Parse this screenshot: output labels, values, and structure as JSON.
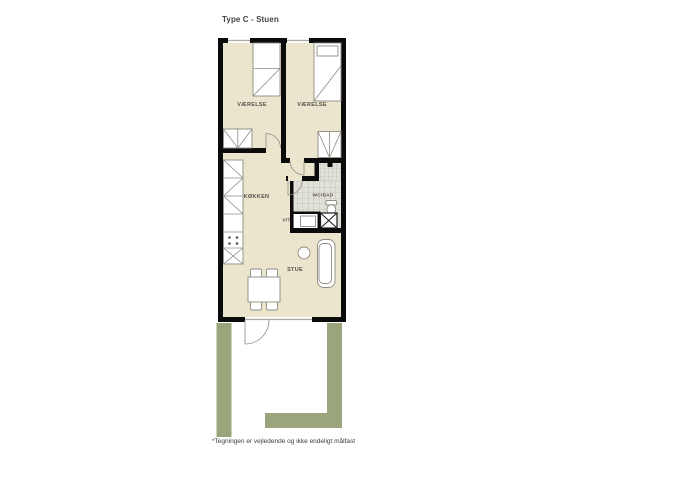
{
  "page": {
    "title": "Type C - Stuen",
    "footnote": "*Tegningen er vejledende og ikke endeligt målfast"
  },
  "labels": {
    "bedroom_left": "VÆRELSE",
    "bedroom_right": "VÆRELSE",
    "kitchen": "KØKKEN",
    "bathroom": "WC/BAD",
    "utility": "V/T",
    "living_room": "STUE"
  },
  "colors": {
    "floor": "#ebe5cd",
    "wall": "#0b0b0b",
    "lawn": "#9ba57b",
    "tile-bg": "#e3e2da",
    "tile-line": "#b3b1a8",
    "furniture-line": "#8e8c84",
    "glass": "#aba9a0",
    "label-text": "#55524a"
  }
}
